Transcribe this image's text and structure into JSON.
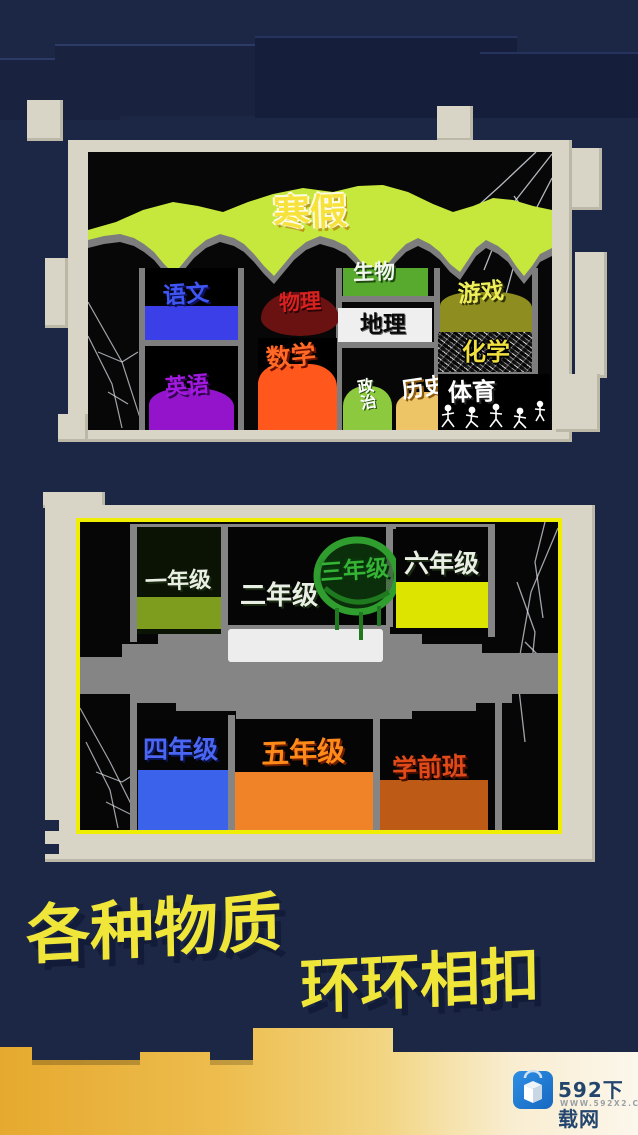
{
  "panel1": {
    "title": "寒假",
    "subjects": [
      {
        "label": "语文",
        "color": "#3a3fe8"
      },
      {
        "label": "物理",
        "color": "#6a1212"
      },
      {
        "label": "数学",
        "color": "#ff571c"
      },
      {
        "label": "英语",
        "color": "#9414cc"
      },
      {
        "label": "生物",
        "color": "#57aa2e"
      },
      {
        "label": "地理",
        "color": "#efefef"
      },
      {
        "label": "政治",
        "color": "#8cc93e"
      },
      {
        "label": "历史",
        "color": "#edc466"
      },
      {
        "label": "游戏",
        "color": "#8d8d20"
      },
      {
        "label": "化学",
        "color": "#efe040"
      },
      {
        "label": "体育",
        "color": "#ffffff"
      }
    ]
  },
  "panel2": {
    "grades": [
      {
        "label": "一年级",
        "color": "#7e9c1e"
      },
      {
        "label": "二年级",
        "color": "#ededed"
      },
      {
        "label": "三年级",
        "color": "#2f9e2f"
      },
      {
        "label": "六年级",
        "color": "#dde400"
      },
      {
        "label": "四年级",
        "color": "#3a62ea"
      },
      {
        "label": "五年级",
        "color": "#f08228"
      },
      {
        "label": "学前班",
        "color": "#bc5a16"
      }
    ],
    "border_color": "#f0ee00"
  },
  "headline": {
    "line1": "各种物质",
    "line2": "环环相扣",
    "color": "#f0e63a"
  },
  "footer": {
    "brand": "592下载网",
    "url": "WWW.592X2.COM",
    "icon": "cube-app-icon",
    "banner_color": "#eebb44",
    "logo_color": "#1f7ad2"
  },
  "theme": {
    "background": "#1c2745",
    "frame": "#d8d5c6",
    "screen": "#070707",
    "divider": "#7e7e7e",
    "title_band": "#c6e83c"
  }
}
